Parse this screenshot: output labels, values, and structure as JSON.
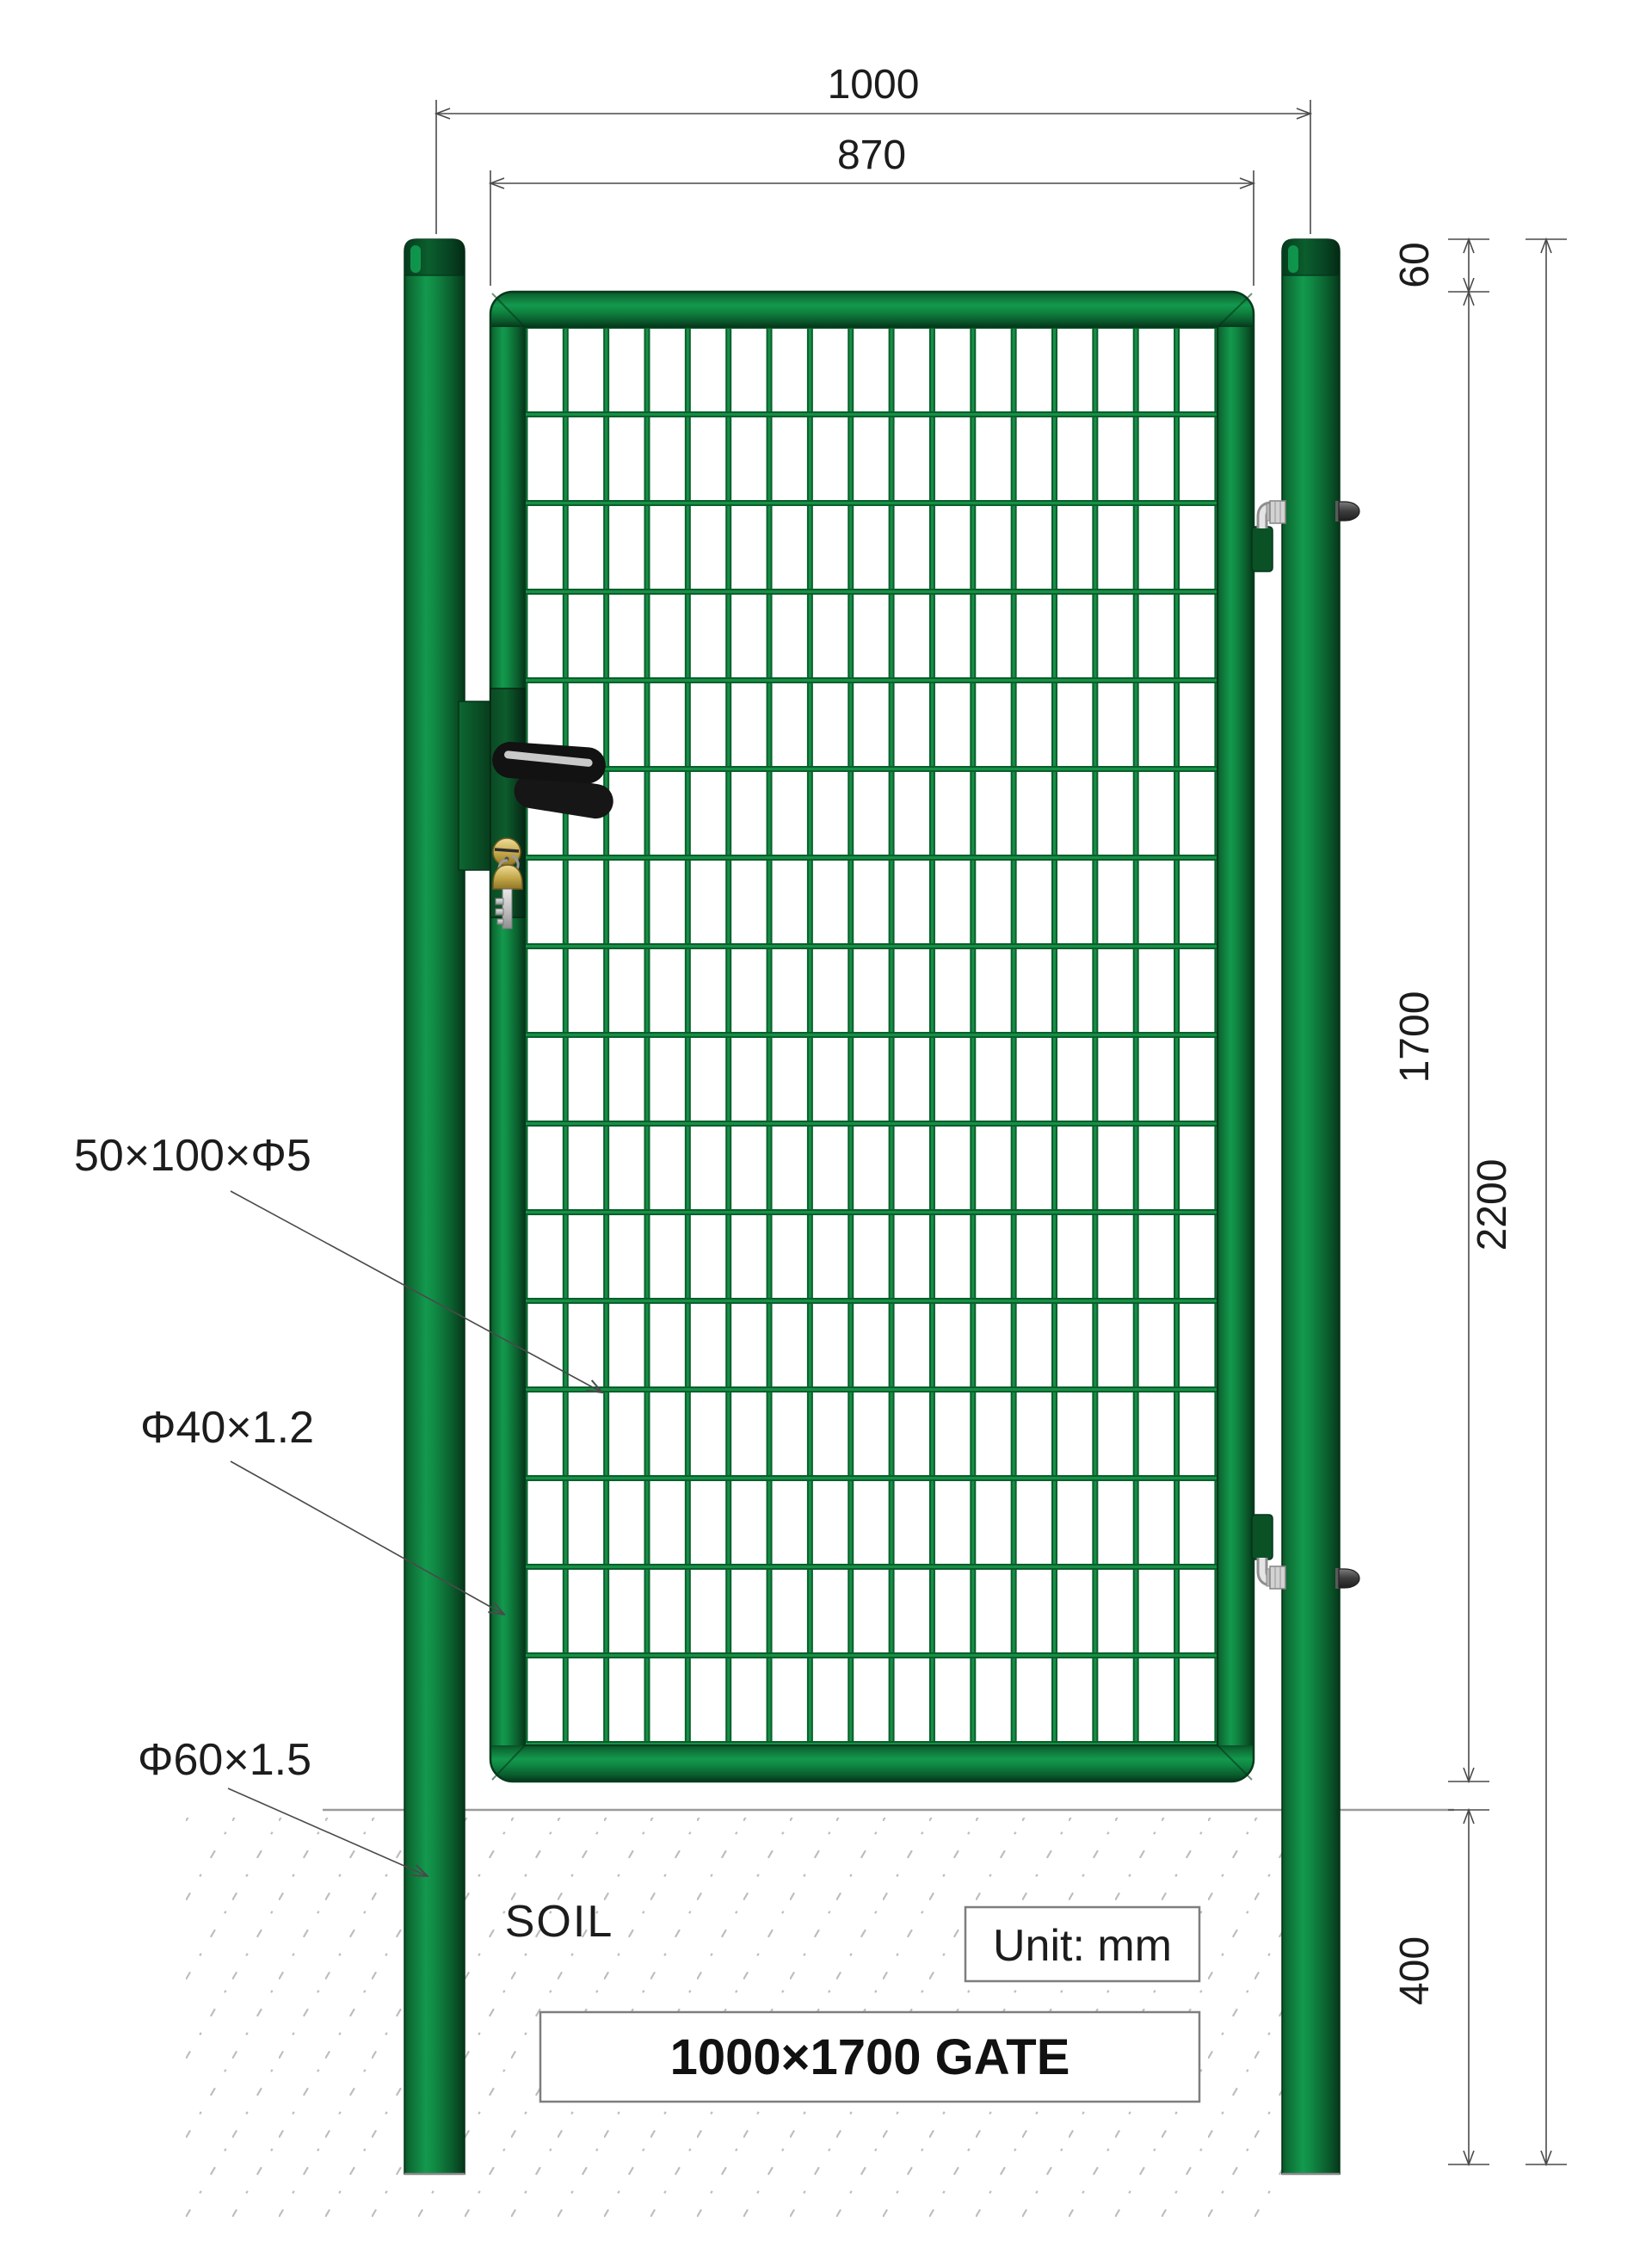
{
  "drawing": {
    "soil_label": "SOIL",
    "unit_label": "Unit: mm",
    "title": "1000×1700 GATE",
    "dimensions": {
      "overall_width": "1000",
      "inner_width": "870",
      "top_offset": "60",
      "gate_height": "1700",
      "post_height": "2200",
      "buried_depth": "400"
    },
    "callouts": {
      "mesh_spec": "50×100×Φ5",
      "frame_spec": "Φ40×1.2",
      "post_spec": "Φ60×1.5"
    },
    "colors": {
      "green_dark": "#05371a",
      "green_mid": "#0c6b33",
      "green_bright": "#13994e",
      "cap_dark": "#063f1f",
      "handle_black": "#141414",
      "key_gold": "#d7bd68",
      "fitting_gray": "#d2d2d2",
      "dim_line": "#4a4a4a",
      "hatch_gray": "#bdbdbd"
    }
  }
}
